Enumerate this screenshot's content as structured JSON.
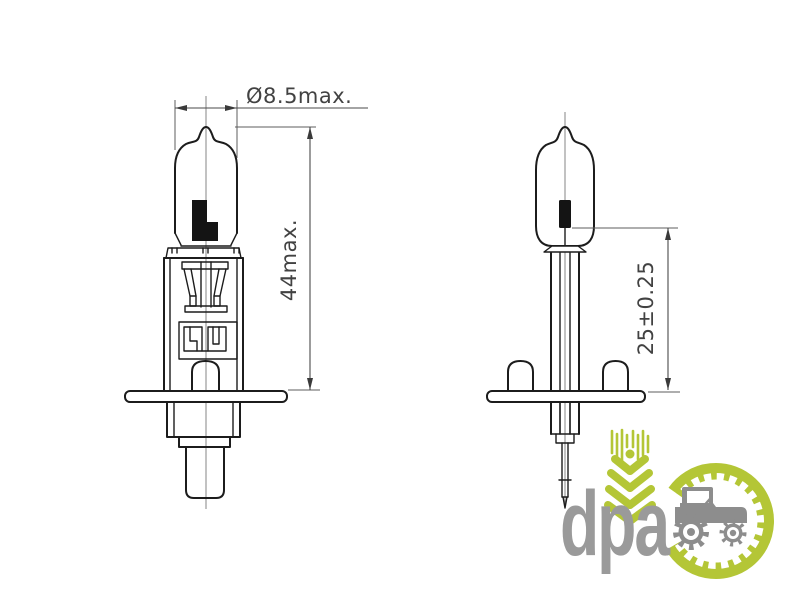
{
  "diagram": {
    "dimensions": {
      "diameter_label": "Ø8.5max.",
      "length_label": "44max.",
      "light_center_label": "25±0.25"
    },
    "line_color": "#1c1c1c",
    "dimension_color": "#4a4a4a"
  },
  "logo": {
    "text": "dpa",
    "green": "#b4c636",
    "gray": "#9a9a9a",
    "tractor_gray": "#8d8d8d",
    "icons": [
      "wheat-icon",
      "gear-ring-icon",
      "tractor-icon"
    ]
  }
}
